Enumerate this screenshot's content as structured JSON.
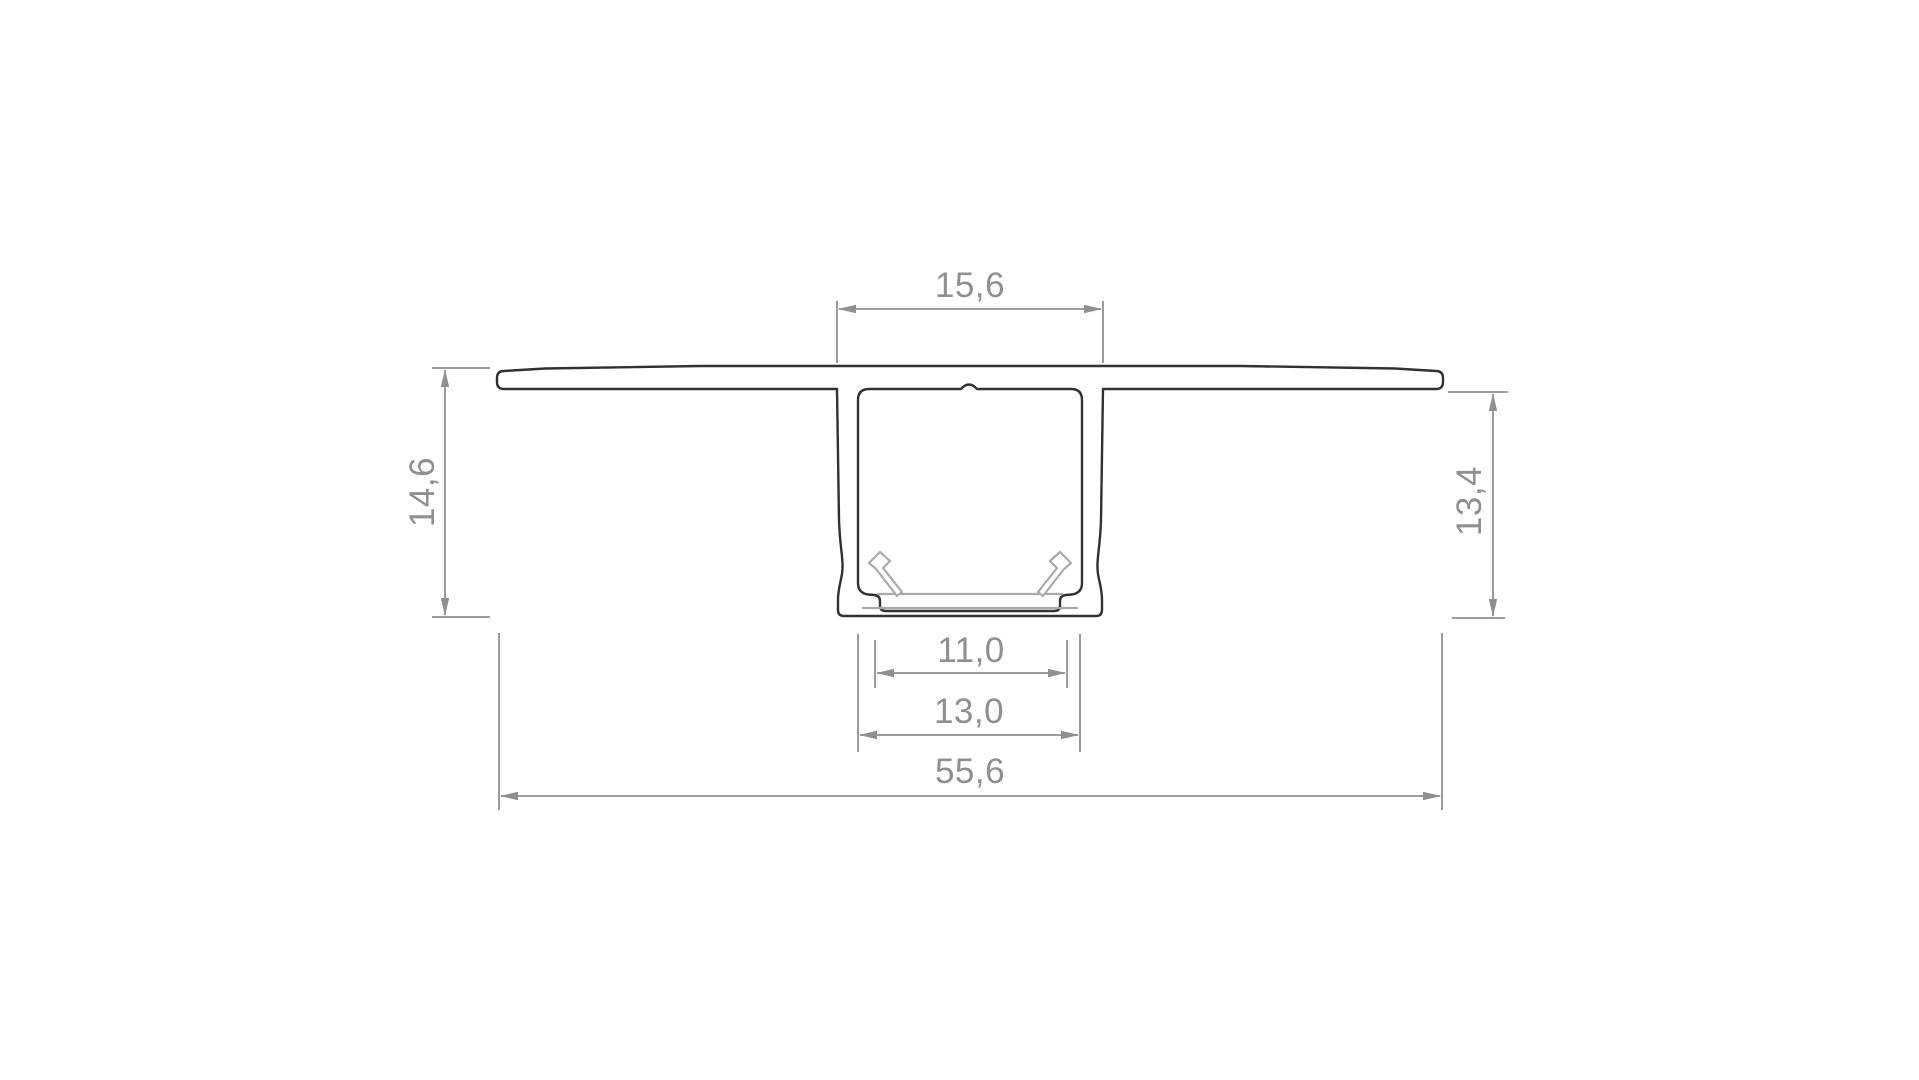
{
  "drawing": {
    "description": "Aluminium LED profile cross-section technical drawing",
    "dimensions": {
      "top_width": "15,6",
      "overall_height": "14,6",
      "body_height": "13,4",
      "led_seat_width": "11,0",
      "channel_inner_width": "13,0",
      "overall_width": "55,6"
    },
    "colors": {
      "profile_outline": "#313133",
      "insert_outline": "#a9a9ab",
      "dimension": "#8f8f91",
      "background": "#ffffff"
    }
  }
}
